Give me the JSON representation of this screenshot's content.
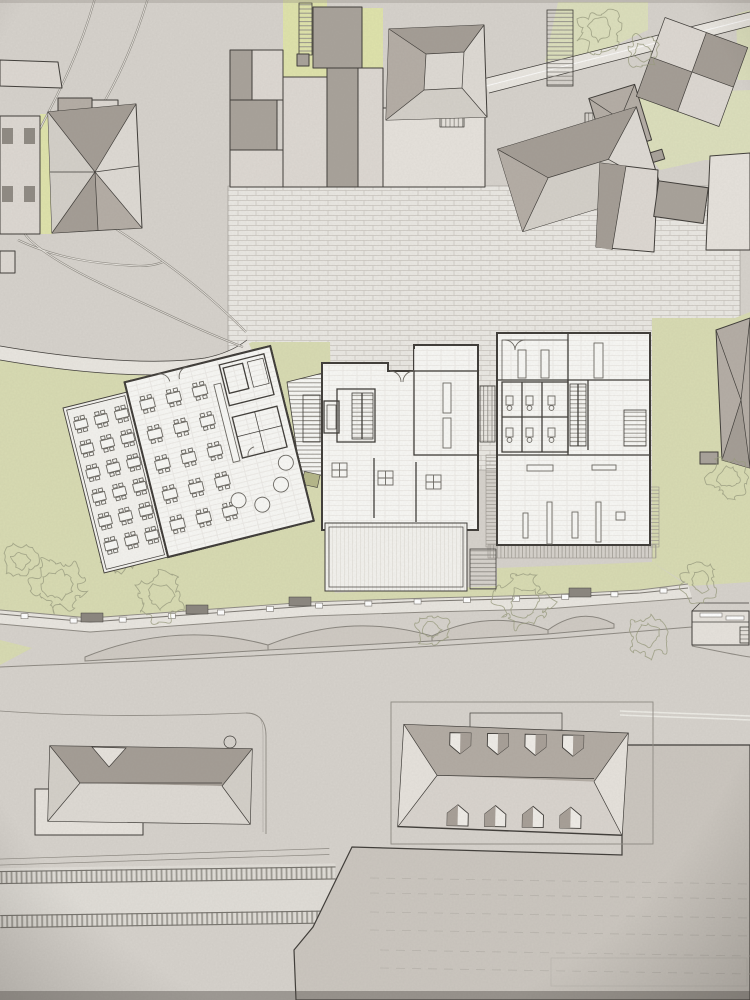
{
  "meta": {
    "kind": "architectural-site-plan",
    "view": "top-down"
  },
  "palette": {
    "base": "#d6d2cc",
    "plazaBg": "#eae8e3",
    "plazaLine": "#c9c5be",
    "pathLight": "#e9e6e0",
    "lawn": "#d8dbb2",
    "lawnSoft": "#dcdfbc",
    "lawnBright": "#dfe3ab",
    "roofDark": "#a49d95",
    "roofMid": "#b4ada5",
    "roofLight": "#dedad4",
    "roofLight2": "#d4d0c9",
    "wallBeige": "#ddd8d2",
    "wallLight": "#e6e2dc",
    "flatGray": "#a8a29a",
    "winDark": "#8f8a83",
    "planWhite": "#f8f8f5",
    "planLine": "#3f3c38",
    "floorLine": "#e7e5e0",
    "furnLine": "#6b6862",
    "roadLine": "#8e8a83",
    "laneWhite": "#f0eee9",
    "fenceLine": "#7d7973",
    "hedgeFill": "#cfcac3",
    "hedgeLine": "#8a867f",
    "treeLine": "#9a9c80",
    "benchDark": "#8b867f",
    "stationTop": "#b2aba3",
    "stationSide": "#d9d4ce",
    "dormerDark": "#a79f97",
    "bigRoof": "#cbc6bf",
    "tieLine": "#8b8881",
    "rail": "#76736d",
    "stairLine": "#8f8c86",
    "deckLine": "#9b978f",
    "planter": "#b5b789"
  },
  "objects": {
    "terrace_tables": {
      "rows": 6,
      "cols": 3
    },
    "hall_tables": {
      "rows": 5,
      "cols": 3
    },
    "round_tables": 4,
    "hall_square_tables": 3,
    "station_dormers": {
      "top": 4,
      "bottom": 4
    },
    "railway_tracks": 2,
    "fence_posts": 14,
    "hedge_scallops": 4,
    "toilets": 6,
    "benches": [
      [
        92,
        617
      ],
      [
        197,
        609
      ],
      [
        300,
        601
      ],
      [
        580,
        592
      ]
    ],
    "trees": [
      [
        600,
        30,
        21
      ],
      [
        642,
        52,
        16
      ],
      [
        58,
        584,
        26
      ],
      [
        160,
        596,
        23
      ],
      [
        118,
        556,
        18
      ],
      [
        525,
        602,
        27
      ],
      [
        648,
        636,
        22
      ],
      [
        700,
        582,
        18
      ],
      [
        728,
        478,
        20
      ],
      [
        432,
        630,
        16
      ],
      [
        20,
        560,
        16
      ]
    ]
  }
}
